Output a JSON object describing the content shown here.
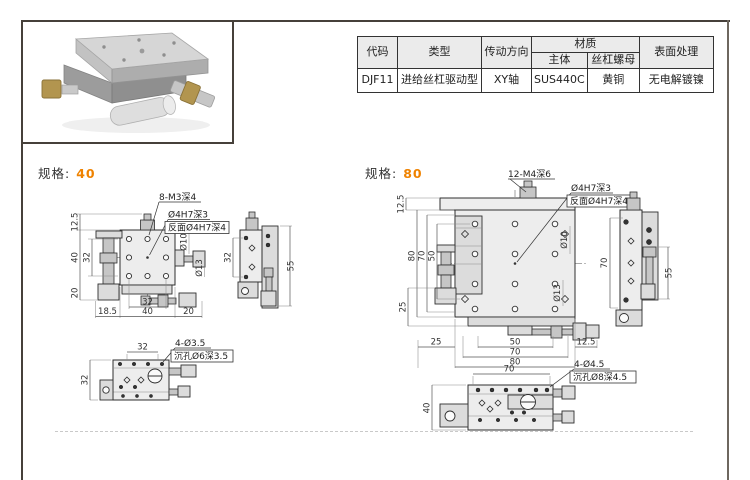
{
  "page": {
    "accent_color": "#ef8200",
    "table_header_bg": "#ebebeb"
  },
  "info_table": {
    "col_code": "代码",
    "col_type": "类型",
    "col_direction": "传动方向",
    "col_material": "材质",
    "col_material_body": "主体",
    "col_material_nut": "丝杠螺母",
    "col_surface": "表面处理",
    "row": {
      "code": "DJF11",
      "type": "进给丝杠驱动型",
      "direction": "XY轴",
      "material_body": "SUS440C",
      "material_nut": "黄铜",
      "surface": "无电解镀镍"
    }
  },
  "spec40": {
    "label": "规格:",
    "size": "40",
    "front": {
      "label_holes": "8-M3深4",
      "label_pin": "Ø4H7深3",
      "label_pin_back": "反面Ø4H7深4",
      "dim_125": "12.5",
      "dim_40": "40",
      "dim_32": "32",
      "dim_20": "20",
      "dim_b185": "18.5",
      "dim_b32": "32",
      "dim_b40": "40",
      "dim_b20": "20",
      "dia10": "Ø10",
      "dia13": "Ø13"
    },
    "side": {
      "dim_32": "32",
      "dim_55": "55"
    },
    "bottom": {
      "dim_t32": "32",
      "dim_l32": "32",
      "label_holes": "4-Ø3.5",
      "label_cbore": "沉孔Ø6深3.5"
    }
  },
  "spec80": {
    "label": "规格:",
    "size": "80",
    "front": {
      "label_holes": "12-M4深6",
      "label_pin": "Ø4H7深3",
      "label_pin_back": "反面Ø4H7深4",
      "dim_125": "12.5",
      "dim_80": "80",
      "dim_70": "70",
      "dim_50": "50",
      "dim_25": "25",
      "dim_b25": "25",
      "dim_b50": "50",
      "dim_b70": "70",
      "dim_b80": "80",
      "dim_b125": "12.5",
      "dia10": "Ø10",
      "dia13": "Ø13"
    },
    "side": {
      "dim_70": "70",
      "dim_55": "55"
    },
    "bottom": {
      "dim_t70": "70",
      "dim_l40": "40",
      "label_holes": "4-Ø4.5",
      "label_cbore": "沉孔Ø8深4.5"
    }
  }
}
